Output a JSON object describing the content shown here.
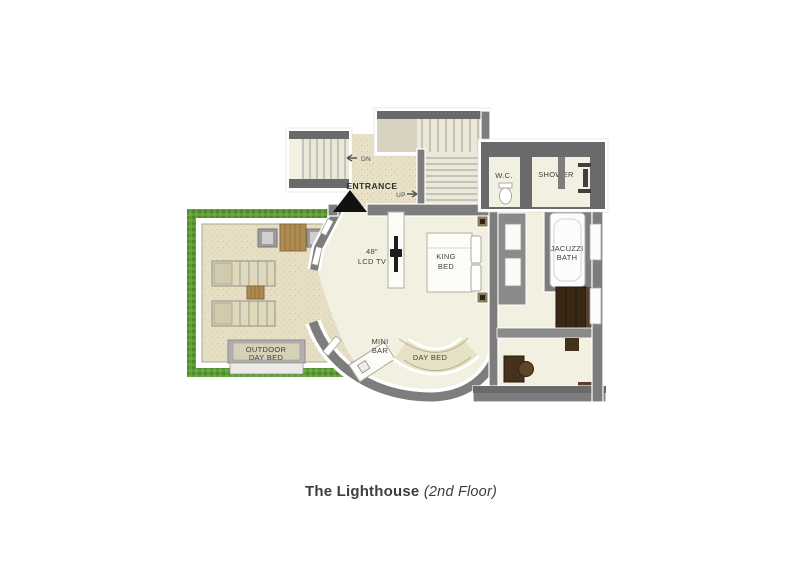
{
  "meta": {
    "kind": "resort villa floor plan",
    "width_px": 802,
    "height_px": 567
  },
  "title": {
    "name": "The Lighthouse",
    "floor": "(2nd Floor)"
  },
  "labels": {
    "dn": "DN",
    "up": "UP",
    "entrance": "ENTRANCE",
    "wc": "W.C.",
    "shower": "SHOWER",
    "tv1": "48\"",
    "tv2": "LCD TV",
    "king1": "KING",
    "king2": "BED",
    "jacuzzi1": "JACUZZI",
    "jacuzzi2": "BATH",
    "outdoor1": "OUTDOOR",
    "outdoor2": "DAY BED",
    "mini1": "MINI",
    "mini2": "BAR",
    "daybed": "DAY BED"
  },
  "colors": {
    "wall": "#7d7d7d",
    "wall_dark": "#646464",
    "indoor_floor": "#f2f0e1",
    "terrace_floor": "#e6dfc3",
    "stair_floor": "#ece8d8",
    "hedge_green": "#5f9c38",
    "wood": "#b08b52",
    "dark_wood": "#3a2817",
    "label_text": "#3f3f3f"
  }
}
